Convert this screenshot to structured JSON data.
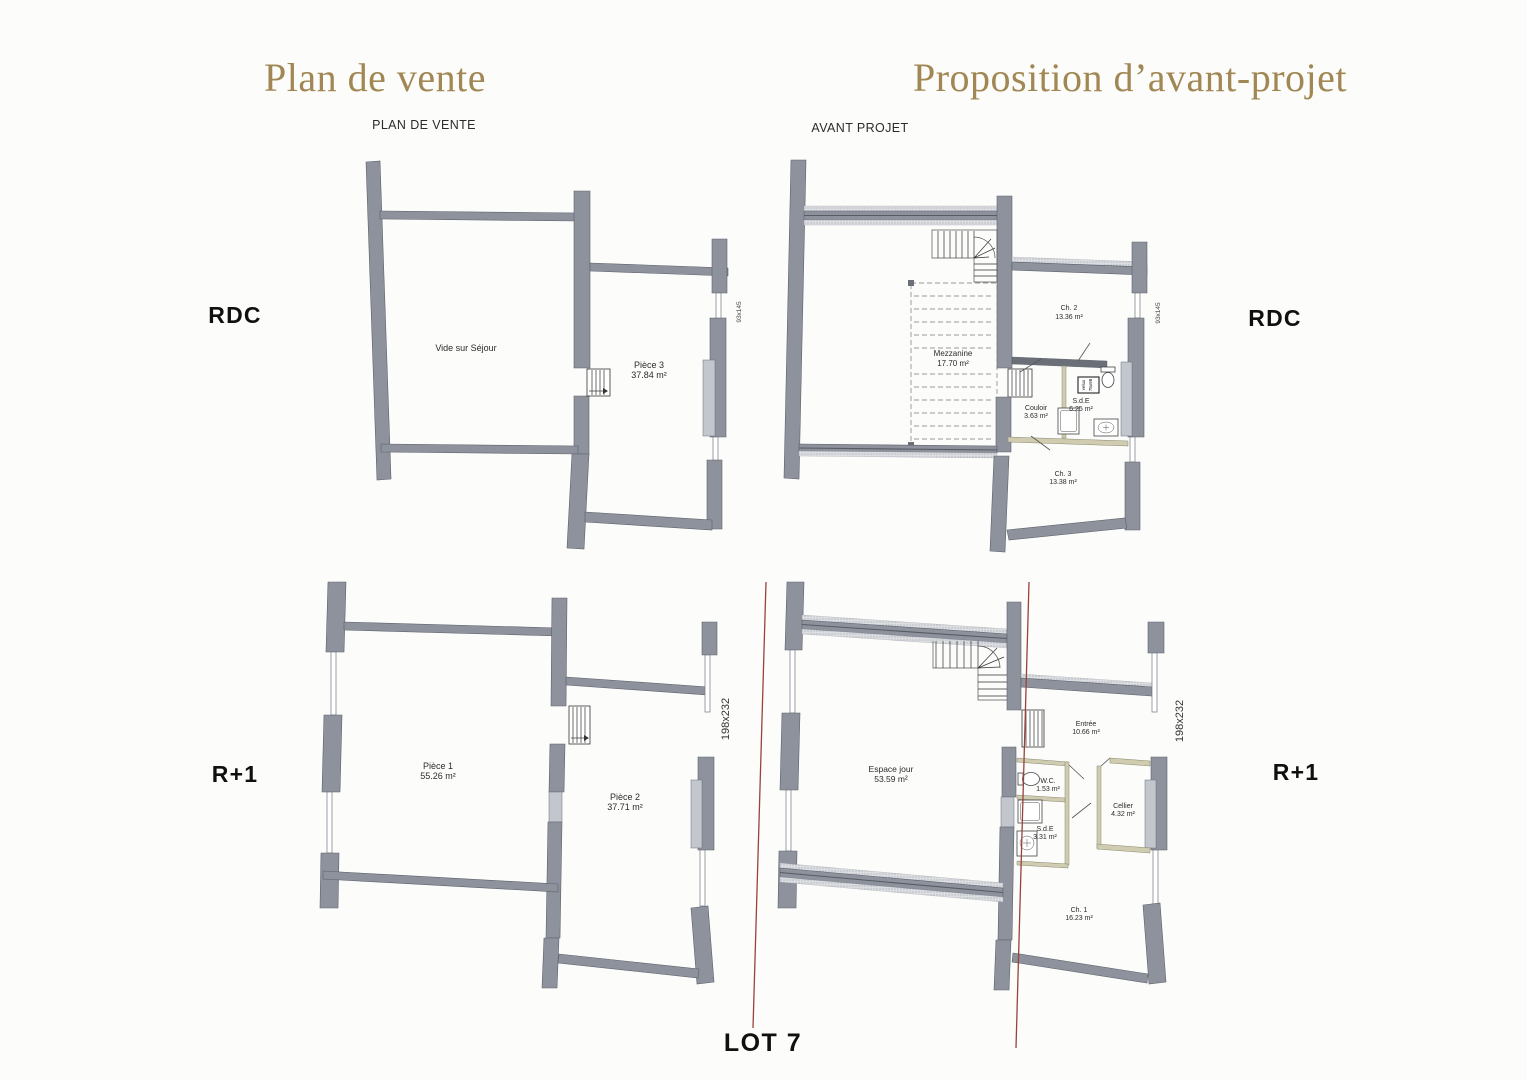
{
  "page": {
    "background": "#fcfcfa",
    "accent_color": "#a18753",
    "wall_color": "#8e929c",
    "red_line_color": "#99423a",
    "title_left": "Plan de vente",
    "title_right": "Proposition d’avant-projet",
    "subtitle_left": "PLAN DE VENTE",
    "subtitle_right": "AVANT PROJET",
    "lot_label": "LOT 7"
  },
  "floor_labels": {
    "left_rdc": "RDC",
    "right_rdc": "RDC",
    "left_r1": "R+1",
    "right_r1": "R+1"
  },
  "plans": {
    "pv_rdc": {
      "rooms": {
        "vide": {
          "name": "Vide sur Séjour"
        },
        "piece3": {
          "name": "Pièce 3",
          "area": "37.84 m²"
        }
      },
      "window_label": "93x145"
    },
    "ap_rdc": {
      "rooms": {
        "mezzanine": {
          "name": "Mezzanine",
          "area": "17.70 m²"
        },
        "ch2": {
          "name": "Ch. 2",
          "area": "13.36 m²"
        },
        "couloir": {
          "name": "Couloir",
          "area": "3.63 m²"
        },
        "sde": {
          "name": "S.d.E",
          "area": "6.25 m²"
        },
        "ch3": {
          "name": "Ch. 3",
          "area": "13.38 m²"
        }
      },
      "velux": {
        "line1": "velux",
        "line2": "78x98"
      },
      "window_label": "93x145"
    },
    "pv_r1": {
      "rooms": {
        "piece1": {
          "name": "Pièce 1",
          "area": "55.26 m²"
        },
        "piece2": {
          "name": "Pièce 2",
          "area": "37.71 m²"
        }
      },
      "window_label": "198x232"
    },
    "ap_r1": {
      "rooms": {
        "espace_jour": {
          "name": "Espace jour",
          "area": "53.59 m²"
        },
        "entree": {
          "name": "Entrée",
          "area": "10.66 m²"
        },
        "wc": {
          "name": "W.C.",
          "area": "1.53 m²"
        },
        "sde": {
          "name": "S.d.E",
          "area": "3.31 m²"
        },
        "cellier": {
          "name": "Cellier",
          "area": "4.32 m²"
        },
        "ch1": {
          "name": "Ch. 1",
          "area": "16.23 m²"
        }
      },
      "window_label": "198x232"
    }
  }
}
